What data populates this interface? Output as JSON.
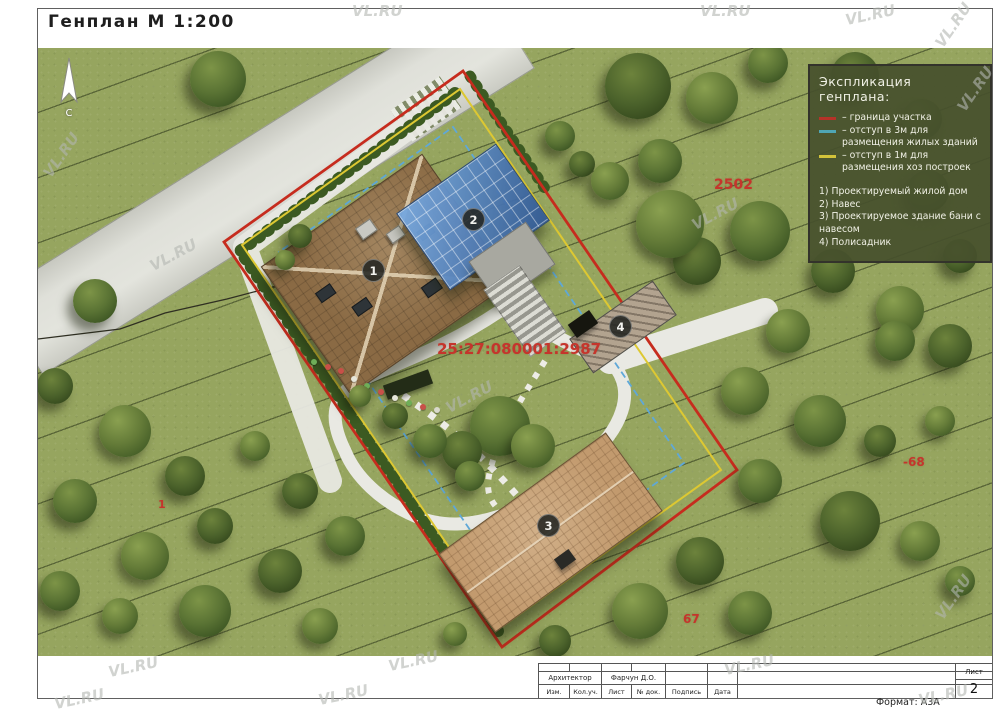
{
  "title": "Генплан М 1:200",
  "north_label": "С",
  "watermark_text": "VL.RU",
  "legend": {
    "title": "Экспликация генплана:",
    "lines": [
      {
        "color": "#b53228",
        "label": "– граница участка"
      },
      {
        "color": "#4fa6b5",
        "label": "– отступ в 3м для размещения жилых зданий"
      },
      {
        "color": "#d2c23a",
        "label": "– отступ в 1м для размещения хоз построек"
      }
    ],
    "items": [
      "1) Проектируемый жилой дом",
      "2) Навес",
      "3) Проектируемое здание бани с навесом",
      "4) Полисадник"
    ]
  },
  "markers": [
    {
      "n": "1",
      "name": "house",
      "x": 334,
      "y": 221
    },
    {
      "n": "2",
      "name": "canopy",
      "x": 434,
      "y": 170
    },
    {
      "n": "3",
      "name": "bathhouse",
      "x": 509,
      "y": 476
    },
    {
      "n": "4",
      "name": "front-garden",
      "x": 581,
      "y": 277
    }
  ],
  "annotations": [
    {
      "text": "2502",
      "x": 676,
      "y": 129,
      "size": 14
    },
    {
      "text": "25:27:080001:2987",
      "x": 399,
      "y": 292,
      "size": 15
    },
    {
      "text": "-68",
      "x": 865,
      "y": 407,
      "size": 12
    },
    {
      "text": "67",
      "x": 645,
      "y": 564,
      "size": 12
    },
    {
      "text": "1",
      "x": 120,
      "y": 450,
      "size": 11
    }
  ],
  "trees": [
    [
      180,
      31,
      28
    ],
    [
      600,
      38,
      33
    ],
    [
      674,
      50,
      26
    ],
    [
      730,
      15,
      20
    ],
    [
      817,
      28,
      24
    ],
    [
      884,
      71,
      20
    ],
    [
      522,
      88,
      15
    ],
    [
      544,
      116,
      13
    ],
    [
      572,
      133,
      19
    ],
    [
      622,
      113,
      22
    ],
    [
      659,
      213,
      24
    ],
    [
      632,
      176,
      34
    ],
    [
      722,
      183,
      30
    ],
    [
      795,
      223,
      22
    ],
    [
      862,
      262,
      24
    ],
    [
      890,
      143,
      21
    ],
    [
      922,
      208,
      17
    ],
    [
      750,
      283,
      22
    ],
    [
      857,
      293,
      20
    ],
    [
      912,
      298,
      22
    ],
    [
      707,
      343,
      24
    ],
    [
      782,
      373,
      26
    ],
    [
      842,
      393,
      16
    ],
    [
      902,
      373,
      15
    ],
    [
      722,
      433,
      22
    ],
    [
      812,
      473,
      30
    ],
    [
      882,
      493,
      20
    ],
    [
      922,
      533,
      15
    ],
    [
      662,
      513,
      24
    ],
    [
      602,
      563,
      28
    ],
    [
      712,
      565,
      22
    ],
    [
      517,
      593,
      16
    ],
    [
      417,
      586,
      12
    ],
    [
      57,
      253,
      22
    ],
    [
      17,
      338,
      18
    ],
    [
      87,
      383,
      26
    ],
    [
      37,
      453,
      22
    ],
    [
      147,
      428,
      20
    ],
    [
      107,
      508,
      24
    ],
    [
      22,
      543,
      20
    ],
    [
      177,
      478,
      18
    ],
    [
      82,
      568,
      18
    ],
    [
      167,
      563,
      26
    ],
    [
      242,
      523,
      22
    ],
    [
      282,
      578,
      18
    ],
    [
      307,
      488,
      20
    ],
    [
      262,
      443,
      18
    ],
    [
      217,
      398,
      15
    ],
    [
      462,
      378,
      30
    ],
    [
      424,
      403,
      20
    ],
    [
      495,
      398,
      22
    ],
    [
      392,
      393,
      17
    ],
    [
      357,
      368,
      13
    ],
    [
      322,
      348,
      11
    ],
    [
      432,
      428,
      15
    ],
    [
      262,
      188,
      12
    ],
    [
      247,
      212,
      10
    ]
  ],
  "flowers": [
    {
      "x": 300,
      "y": 320,
      "c": "#c85048"
    },
    {
      "x": 313,
      "y": 328,
      "c": "#e6e6da"
    },
    {
      "x": 326,
      "y": 335,
      "c": "#6fae58"
    },
    {
      "x": 340,
      "y": 341,
      "c": "#c85048"
    },
    {
      "x": 354,
      "y": 347,
      "c": "#e6e6da"
    },
    {
      "x": 368,
      "y": 352,
      "c": "#6fae58"
    },
    {
      "x": 382,
      "y": 356,
      "c": "#c85048"
    },
    {
      "x": 396,
      "y": 359,
      "c": "#d9d9cc"
    },
    {
      "x": 273,
      "y": 311,
      "c": "#6fae58"
    },
    {
      "x": 287,
      "y": 316,
      "c": "#c85048"
    }
  ],
  "watermarks": [
    {
      "x": 352,
      "y": 2,
      "r": 0
    },
    {
      "x": 700,
      "y": 2,
      "r": 0
    },
    {
      "x": 845,
      "y": 6,
      "r": -12
    },
    {
      "x": 928,
      "y": 16,
      "r": -55
    },
    {
      "x": 950,
      "y": 80,
      "r": -55
    },
    {
      "x": 36,
      "y": 146,
      "r": -55
    },
    {
      "x": 148,
      "y": 246,
      "r": -28
    },
    {
      "x": 444,
      "y": 388,
      "r": -28
    },
    {
      "x": 690,
      "y": 205,
      "r": -28
    },
    {
      "x": 928,
      "y": 588,
      "r": -55
    },
    {
      "x": 724,
      "y": 656,
      "r": -12
    },
    {
      "x": 388,
      "y": 652,
      "r": -12
    },
    {
      "x": 108,
      "y": 658,
      "r": -12
    },
    {
      "x": 318,
      "y": 686,
      "r": -12
    },
    {
      "x": 54,
      "y": 690,
      "r": -12
    },
    {
      "x": 918,
      "y": 686,
      "r": -12
    }
  ],
  "title_block": {
    "architect_label": "Архитектор",
    "architect_name": "Фарчун Д.О.",
    "columns": [
      "Изм.",
      "Кол.уч.",
      "Лист",
      "№ док.",
      "Подпись",
      "Дата"
    ],
    "sheet_label": "Лист",
    "sheet_number": "2",
    "format_label": "Формат: А3А"
  }
}
